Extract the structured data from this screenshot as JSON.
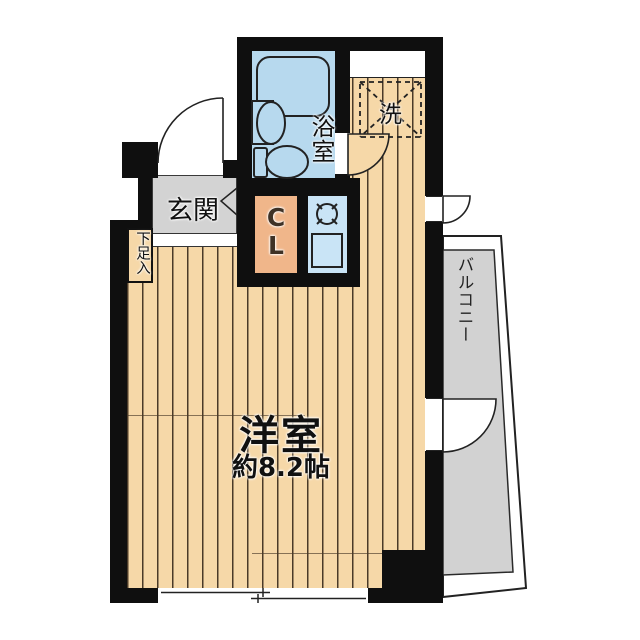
{
  "floorplan": {
    "type": "studio-apartment-floor-plan",
    "rooms": {
      "western_room": {
        "name": "洋室",
        "area": "約8.2帖"
      },
      "entrance": {
        "name": "玄関"
      },
      "bathroom": {
        "name": "浴室"
      },
      "closet": {
        "name": "C\nL"
      },
      "washer_space": {
        "name": "洗"
      },
      "shoe_cabinet": {
        "name": "下足入"
      },
      "balcony": {
        "name": "バルコニー"
      }
    },
    "colors": {
      "wall": "#0f0f0f",
      "flooring": "#f6d8a8",
      "flooring_stripe": "#4a3a28",
      "bathroom_blue": "#b7d9ee",
      "kitchen_blue": "#c9e4f6",
      "closet_peach": "#f0b68a",
      "entrance_gray": "#d3d3d3",
      "balcony_gray": "#d2d2d2"
    }
  }
}
